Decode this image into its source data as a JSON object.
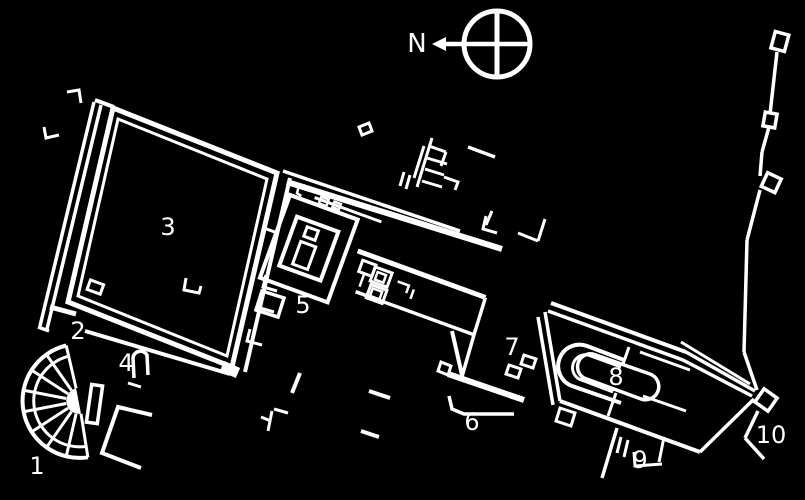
{
  "plan": {
    "background_color": "#000000",
    "line_color": "#ffffff",
    "compass": {
      "north_label": "N"
    },
    "site_labels": [
      {
        "num": "1",
        "x": 37,
        "y": 466
      },
      {
        "num": "2",
        "x": 78,
        "y": 331
      },
      {
        "num": "3",
        "x": 168,
        "y": 227
      },
      {
        "num": "4",
        "x": 126,
        "y": 363
      },
      {
        "num": "5",
        "x": 303,
        "y": 305
      },
      {
        "num": "6",
        "x": 472,
        "y": 422
      },
      {
        "num": "7",
        "x": 512,
        "y": 347
      },
      {
        "num": "8",
        "x": 616,
        "y": 377
      },
      {
        "num": "9",
        "x": 640,
        "y": 460
      },
      {
        "num": "10",
        "x": 771,
        "y": 435
      }
    ]
  }
}
